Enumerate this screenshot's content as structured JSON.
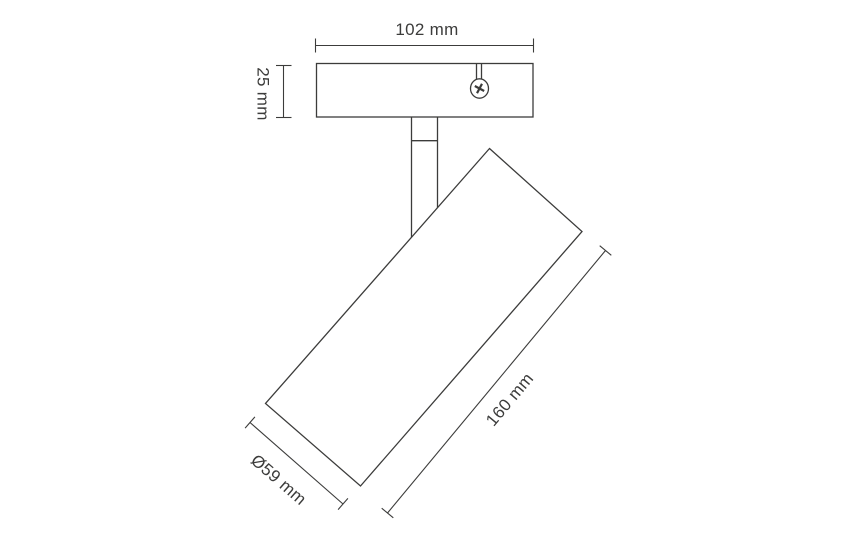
{
  "drawing": {
    "kind": "product-dimension-drawing",
    "subject": "adjustable ceiling spotlight",
    "colors": {
      "background": "#ffffff",
      "line": "#3c3c3b",
      "text": "#3c3c3b"
    },
    "labels": {
      "bracket_width": "102 mm",
      "bracket_height": "25 mm",
      "body_length": "160 mm",
      "body_diameter": "Ø59 mm"
    },
    "icons": {
      "screw": "phillips-screw-icon"
    }
  }
}
